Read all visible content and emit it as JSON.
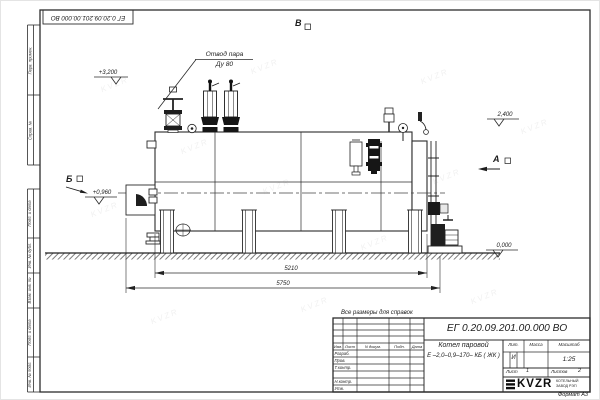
{
  "stamp": {
    "designation": "ЕГ 0.20.09.201.00.000  ВО"
  },
  "margin_labels": {
    "perv_primen": "Перв. примен.",
    "sprav_no": "Справ. №",
    "podp_data_1": "Подп. и дата",
    "inv_dubl": "Инв. № дубл.",
    "vzam_inv": "Взам. инв. №",
    "podp_data_2": "Подп. и дата",
    "inv_podl": "Инв. № подл."
  },
  "drawing": {
    "callout_line1": "Отвод пара",
    "callout_line2": "Ду 80",
    "elevation_top": "+3,200",
    "elevation_right": "2,400",
    "elevation_burner": "+0,960",
    "elevation_ground": "0,000",
    "view_b": "Б",
    "view_v": "В",
    "view_a": "А",
    "dim_inner": "5210",
    "dim_outer": "5750"
  },
  "note": "Все размеры для справок",
  "title_block": {
    "designation": "ЕГ 0.20.09.201.00.000  ВО",
    "product_line1": "Котел паровой",
    "product_line2": "Е –2,0–0,9–170– КБ ( ЖК )",
    "col_izm": "Изм.",
    "col_list": "Лист",
    "col_ndokum": "N докум.",
    "col_podp": "Подп.",
    "col_data": "Дата",
    "row_razrab": "Разраб.",
    "row_prov": "Пров.",
    "row_tkontr": "Т.контр.",
    "row_nkontr": "Н.контр.",
    "row_utv": "Утв.",
    "lit_label": "Лит.",
    "lit_value": "И",
    "massa_label": "Масса",
    "scale_label": "Масштаб",
    "scale_value": "1:25",
    "sheet_label": "Лист",
    "sheet_value": "1",
    "sheets_label": "Листов",
    "sheets_value": "2",
    "company_logo": "KVZR",
    "company_line1": "КОТЕЛЬНЫЙ",
    "company_line2": "ЗАВОД РЭП",
    "format": "Формат А3"
  },
  "watermark": "KVZR"
}
